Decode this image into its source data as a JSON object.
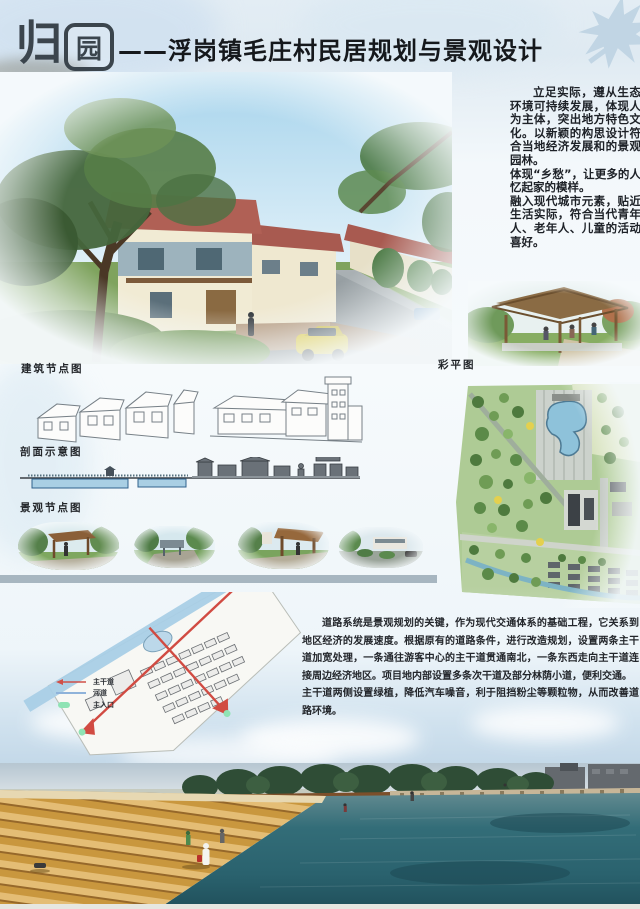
{
  "header": {
    "logo": {
      "char1": "归",
      "char2": "园"
    },
    "title": "——浮岗镇毛庄村民居规划与景观设计"
  },
  "intro": {
    "paragraphs": [
      "立足实际，遵从生态环境可持续发展，体现人为主体，突出地方特色文化。以新颖的构思设计符合当地经济发展和的景观园林。",
      "体现“乡愁”，让更多的人忆起家的模样。",
      "融入现代城市元素，贴近生活实际，符合当代青年人、老年人、儿童的活动喜好。"
    ]
  },
  "section_labels": {
    "building_nodes": "建筑节点图",
    "color_plan": "彩平图",
    "section_diagram": "剖面示意图",
    "landscape_nodes": "景观节点图"
  },
  "road_system": {
    "legend": [
      {
        "symbol": "main-road-arrow",
        "color": "#d05048",
        "label": "主干道"
      },
      {
        "symbol": "river-line",
        "color": "#8fb3da",
        "label": "河道"
      },
      {
        "symbol": "main-entrance-marker",
        "color": "#8fe3b4",
        "label": "主入口"
      }
    ],
    "paragraphs": [
      "道路系统是景观规划的关键，作为现代交通体系的基础工程，它关系到地区经济的发展速度。根据原有的道路条件，进行改造规划，设置两条主干道加宽处理，一条通往游客中心的主干道贯通南北，一条东西走向主干道连接周边经济地区。项目地内部设置多条次干道及部分林荫小道，便利交通。",
      "主干道两侧设置绿植，降低汽车噪音，利于阻挡粉尘等颗粒物，从而改善道路环境。"
    ]
  },
  "illustrations": {
    "village_street_render": "village-street-render",
    "pavilion_render": "pavilion-render",
    "building_sketches": "building-node-sketches",
    "section_diagram": "section-diagram-drawing",
    "color_master_plan": "color-master-plan",
    "landscape_nodes": "landscape-node-renders",
    "road_plan_sketch": "road-system-plan",
    "waterfront_render": "waterfront-steps-render",
    "maple_leaf": "maple-leaf-decoration"
  },
  "colors": {
    "logo_ink": "#3b454d",
    "divider": "#a7b6c0",
    "water_teal": "#2a626e",
    "steps_gold": "#c9973e",
    "plan_green": "#a9c893",
    "pond_blue": "#8ec2da"
  }
}
